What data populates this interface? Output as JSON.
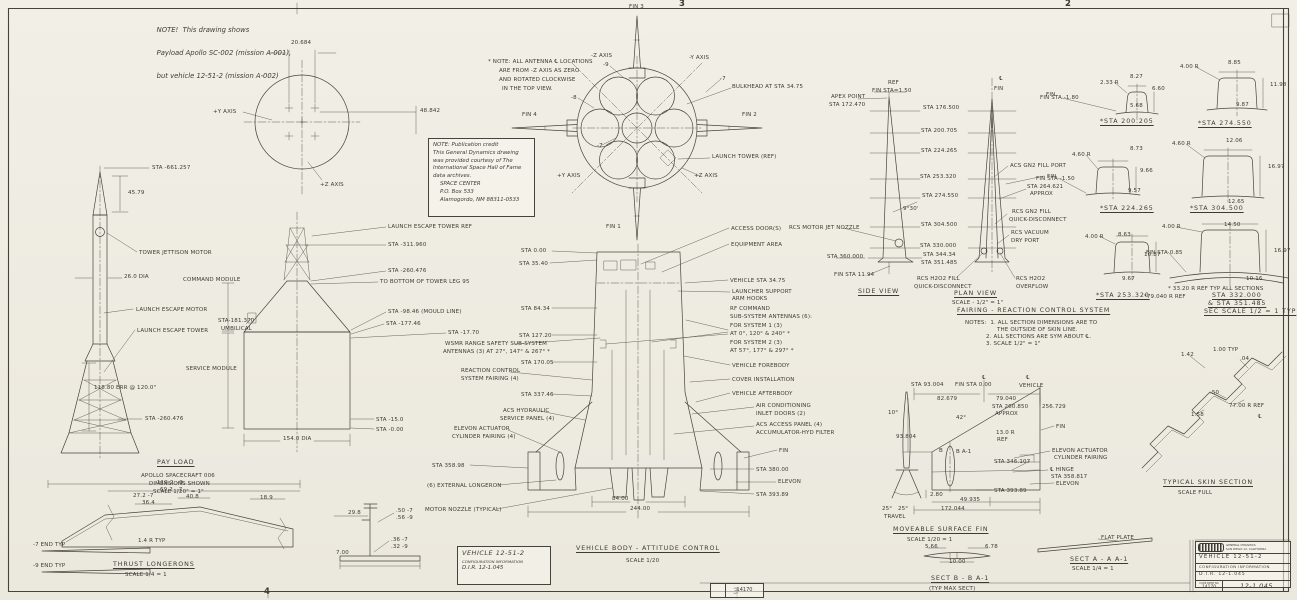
{
  "scope_note": {
    "lines": [
      "NOTE!  This drawing shows",
      "Payload Apollo SC-002 (mission A-001),",
      "but vehicle 12-51-2 (mission A-002)"
    ]
  },
  "credit_note": {
    "lines": [
      "NOTE: Publication credit",
      "This General Dynamics drawing",
      "was provided courtesy of The",
      "International Space Hall of Fame",
      "data archives.",
      "SPACE CENTER",
      "P.O. Box 533",
      "Alamogordo, NM 88311-0533"
    ]
  },
  "info_box": {
    "vehicle": "VEHICLE  12-51-2",
    "config": "CONFIGURATION INFORMATION",
    "dir": "D.I.R.  12-1.045"
  },
  "title_block": {
    "company": "GENERAL DYNAMICS",
    "location": "SAN DIEGO 12, CALIFORNIA",
    "vehicle": "VEHICLE  12-51-2",
    "config": "CONFIGURATION INFORMATION",
    "dir": "D.I.R.  12-1.045",
    "code_label": "CODE IDENT NO",
    "code": "14170",
    "number": "12-1.045"
  },
  "stamp": {
    "number": "14170"
  },
  "labels": [
    {
      "t": "20.684",
      "x": 291,
      "y": 40
    },
    {
      "t": "48.842",
      "x": 420,
      "y": 108
    },
    {
      "t": "+Y AXIS",
      "x": 213,
      "y": 109
    },
    {
      "t": "+Z AXIS",
      "x": 320,
      "y": 182
    },
    {
      "t": "STA -661.257",
      "x": 152,
      "y": 165
    },
    {
      "t": "45.79",
      "x": 128,
      "y": 190
    },
    {
      "t": "TOWER JETTISON MOTOR",
      "x": 139,
      "y": 250
    },
    {
      "t": "26.0 DIA",
      "x": 124,
      "y": 274
    },
    {
      "t": "LAUNCH ESCAPE MOTOR",
      "x": 136,
      "y": 307
    },
    {
      "t": "LAUNCH ESCAPE TOWER",
      "x": 137,
      "y": 328
    },
    {
      "t": "118.80 ERR @ 120.0\"",
      "x": 94,
      "y": 385
    },
    {
      "t": "STA -260.476",
      "x": 145,
      "y": 416
    },
    {
      "t": "PAY LOAD",
      "x": 157,
      "y": 459,
      "c": "t"
    },
    {
      "t": "APOLLO SPACECRAFT 006",
      "x": 141,
      "y": 473
    },
    {
      "t": "DIMENSIONS SHOWN",
      "x": 149,
      "y": 481
    },
    {
      "t": "SCALE 1/20\" = 1\"",
      "x": 153,
      "y": 489
    },
    {
      "t": "COMMAND MODULE",
      "x": 183,
      "y": 277
    },
    {
      "t": "STA-181.370",
      "x": 218,
      "y": 318
    },
    {
      "t": "UMBILICAL",
      "x": 221,
      "y": 326
    },
    {
      "t": "SERVICE MODULE",
      "x": 186,
      "y": 366
    },
    {
      "t": "LAUNCH ESCAPE TOWER REF",
      "x": 388,
      "y": 224
    },
    {
      "t": "STA -311.960",
      "x": 388,
      "y": 242
    },
    {
      "t": "STA -260.476",
      "x": 388,
      "y": 268
    },
    {
      "t": "TO BOTTOM OF TOWER LEG 95",
      "x": 380,
      "y": 279
    },
    {
      "t": "STA -98.46 (MOULD LINE)",
      "x": 388,
      "y": 309
    },
    {
      "t": "STA -177.46",
      "x": 386,
      "y": 321
    },
    {
      "t": "STA -17.70",
      "x": 448,
      "y": 330
    },
    {
      "t": "STA -15.0",
      "x": 376,
      "y": 417
    },
    {
      "t": "STA -0.00",
      "x": 376,
      "y": 427
    },
    {
      "t": "154.0 DIA",
      "x": 283,
      "y": 436
    },
    {
      "t": "FIN 3",
      "x": 629,
      "y": 4
    },
    {
      "t": "-Z AXIS",
      "x": 591,
      "y": 53
    },
    {
      "t": "-Y AXIS",
      "x": 689,
      "y": 55
    },
    {
      "t": "* NOTE: ALL ANTENNA ℄ LOCATIONS",
      "x": 488,
      "y": 59
    },
    {
      "t": "ARE FROM -Z AXIS AS ZERO",
      "x": 499,
      "y": 68
    },
    {
      "t": "AND ROTATED CLOCKWISE",
      "x": 499,
      "y": 77
    },
    {
      "t": "IN THE TOP VIEW.",
      "x": 502,
      "y": 86
    },
    {
      "t": "-9",
      "x": 603,
      "y": 62
    },
    {
      "t": "-7",
      "x": 720,
      "y": 76
    },
    {
      "t": "-8",
      "x": 571,
      "y": 95
    },
    {
      "t": "-7",
      "x": 597,
      "y": 143
    },
    {
      "t": "BULKHEAD AT STA 34.75",
      "x": 732,
      "y": 84
    },
    {
      "t": "FIN 4",
      "x": 522,
      "y": 112
    },
    {
      "t": "FIN 2",
      "x": 742,
      "y": 112
    },
    {
      "t": "LAUNCH TOWER (REF)",
      "x": 712,
      "y": 154
    },
    {
      "t": "+Z AXIS",
      "x": 694,
      "y": 173
    },
    {
      "t": "+Y AXIS",
      "x": 557,
      "y": 173
    },
    {
      "t": "FIN 1",
      "x": 606,
      "y": 224
    },
    {
      "t": "STA 0.00",
      "x": 521,
      "y": 248
    },
    {
      "t": "STA 35.40",
      "x": 519,
      "y": 261
    },
    {
      "t": "STA 84.34",
      "x": 521,
      "y": 306
    },
    {
      "t": "STA 127.20",
      "x": 519,
      "y": 333
    },
    {
      "t": "WSMR RANGE SAFETY SUB-SYSTEM",
      "x": 445,
      "y": 341
    },
    {
      "t": "ANTENNAS (3) AT 27°, 147° & 267° *",
      "x": 443,
      "y": 349
    },
    {
      "t": "STA 170.05",
      "x": 521,
      "y": 360
    },
    {
      "t": "REACTION CONTROL",
      "x": 461,
      "y": 368
    },
    {
      "t": "SYSTEM FAIRING (4)",
      "x": 461,
      "y": 376
    },
    {
      "t": "STA 337.46",
      "x": 521,
      "y": 392
    },
    {
      "t": "ACS HYDRAULIC",
      "x": 503,
      "y": 408
    },
    {
      "t": "SERVICE PANEL (4)",
      "x": 500,
      "y": 416
    },
    {
      "t": "ELEVON ACTUATOR",
      "x": 454,
      "y": 426
    },
    {
      "t": "CYLINDER FAIRING (4)",
      "x": 452,
      "y": 434
    },
    {
      "t": "STA 358.98",
      "x": 432,
      "y": 463
    },
    {
      "t": "(6) EXTERNAL LONGERON",
      "x": 427,
      "y": 483
    },
    {
      "t": "MOTOR NOZZLE (TYPICAL)",
      "x": 425,
      "y": 507
    },
    {
      "t": "ACCESS DOOR(S)",
      "x": 731,
      "y": 226
    },
    {
      "t": "EQUIPMENT AREA",
      "x": 731,
      "y": 242
    },
    {
      "t": "VEHICLE STA 34.75",
      "x": 730,
      "y": 278
    },
    {
      "t": "LAUNCHER SUPPORT",
      "x": 732,
      "y": 289
    },
    {
      "t": "ARM HOOKS",
      "x": 732,
      "y": 296
    },
    {
      "t": "RF COMMAND",
      "x": 730,
      "y": 306
    },
    {
      "t": "SUB-SYSTEM ANTENNAS (6):",
      "x": 730,
      "y": 314
    },
    {
      "t": "FOR SYSTEM 1 (3)",
      "x": 730,
      "y": 323
    },
    {
      "t": "AT 0°, 120° & 240° *",
      "x": 730,
      "y": 331
    },
    {
      "t": "FOR SYSTEM 2 (3)",
      "x": 730,
      "y": 340
    },
    {
      "t": "AT 57°, 177° & 297° *",
      "x": 730,
      "y": 348
    },
    {
      "t": "VEHICLE FOREBODY",
      "x": 732,
      "y": 363
    },
    {
      "t": "COVER INSTALLATION",
      "x": 732,
      "y": 377
    },
    {
      "t": "VEHICLE AFTERBODY",
      "x": 732,
      "y": 391
    },
    {
      "t": "AIR CONDITIONING",
      "x": 756,
      "y": 403
    },
    {
      "t": "INLET DOORS (2)",
      "x": 756,
      "y": 411
    },
    {
      "t": "ACS ACCESS PANEL (4)",
      "x": 756,
      "y": 422
    },
    {
      "t": "ACCUMULATOR-HYD FILTER",
      "x": 756,
      "y": 430
    },
    {
      "t": "FIN",
      "x": 779,
      "y": 448
    },
    {
      "t": "STA 380.00",
      "x": 756,
      "y": 467
    },
    {
      "t": "ELEVON",
      "x": 778,
      "y": 479
    },
    {
      "t": "STA 393.89",
      "x": 756,
      "y": 492
    },
    {
      "t": "84.00",
      "x": 612,
      "y": 496
    },
    {
      "t": "244.00",
      "x": 630,
      "y": 506
    },
    {
      "t": "VEHICLE BODY - ATTITUDE CONTROL",
      "x": 576,
      "y": 545,
      "c": "t"
    },
    {
      "t": "SCALE 1/20",
      "x": 626,
      "y": 558
    },
    {
      "t": "REF",
      "x": 888,
      "y": 80
    },
    {
      "t": "FIN STA=1.50",
      "x": 872,
      "y": 88
    },
    {
      "t": "APEX POINT",
      "x": 831,
      "y": 94
    },
    {
      "t": "STA 172.470",
      "x": 829,
      "y": 102
    },
    {
      "t": "℄",
      "x": 999,
      "y": 76
    },
    {
      "t": "FIN",
      "x": 994,
      "y": 86
    },
    {
      "t": "FIN",
      "x": 1046,
      "y": 92
    },
    {
      "t": "STA 176.500",
      "x": 923,
      "y": 105
    },
    {
      "t": "STA 200.705",
      "x": 921,
      "y": 128
    },
    {
      "t": "STA 224.265",
      "x": 921,
      "y": 148
    },
    {
      "t": "STA 253.320",
      "x": 920,
      "y": 174
    },
    {
      "t": "STA 274.550",
      "x": 922,
      "y": 193
    },
    {
      "t": "9°30'",
      "x": 903,
      "y": 206
    },
    {
      "t": "STA 304.500",
      "x": 921,
      "y": 222
    },
    {
      "t": "RCS MOTOR JET NOZZLE",
      "x": 789,
      "y": 225
    },
    {
      "t": "STA 330.000",
      "x": 920,
      "y": 243
    },
    {
      "t": "STA 344.34",
      "x": 923,
      "y": 252
    },
    {
      "t": "STA 351.485",
      "x": 921,
      "y": 260
    },
    {
      "t": "STA 360.000",
      "x": 827,
      "y": 254
    },
    {
      "t": "FIN STA 11.94",
      "x": 834,
      "y": 272
    },
    {
      "t": "SIDE VIEW",
      "x": 858,
      "y": 288,
      "c": "t"
    },
    {
      "t": "PLAN VIEW",
      "x": 954,
      "y": 290,
      "c": "t"
    },
    {
      "t": "SCALE - 1/2\" = 1\"",
      "x": 952,
      "y": 300
    },
    {
      "t": "ACS GN2 FILL PORT",
      "x": 1010,
      "y": 163
    },
    {
      "t": "FIN",
      "x": 1047,
      "y": 174
    },
    {
      "t": "STA 264.621",
      "x": 1027,
      "y": 184
    },
    {
      "t": "APPROX",
      "x": 1030,
      "y": 191
    },
    {
      "t": "RCS GN2 FILL",
      "x": 1012,
      "y": 209
    },
    {
      "t": "QUICK-DISCONNECT",
      "x": 1009,
      "y": 217
    },
    {
      "t": "RCS VACUUM",
      "x": 1011,
      "y": 230
    },
    {
      "t": "DRY PORT",
      "x": 1011,
      "y": 238
    },
    {
      "t": "RCS H2O2 FILL",
      "x": 917,
      "y": 276
    },
    {
      "t": "QUICK-DISCONNECT",
      "x": 914,
      "y": 284
    },
    {
      "t": "RCS H2O2",
      "x": 1016,
      "y": 276
    },
    {
      "t": "OVERFLOW",
      "x": 1016,
      "y": 284
    },
    {
      "t": "FAIRING - REACTION CONTROL SYSTEM",
      "x": 957,
      "y": 307,
      "c": "t"
    },
    {
      "t": "NOTES:  1. ALL SECTION DIMENSIONS ARE TO",
      "x": 965,
      "y": 320
    },
    {
      "t": "THE OUTSIDE OF SKIN LINE.",
      "x": 997,
      "y": 327
    },
    {
      "t": "2. ALL SECTIONS ARE SYM ABOUT ℄.",
      "x": 986,
      "y": 334
    },
    {
      "t": "3. SCALE 1/2\" = 1\"",
      "x": 986,
      "y": 341
    },
    {
      "t": "FIN STA -1.80",
      "x": 1040,
      "y": 95
    },
    {
      "t": "2.33 R",
      "x": 1100,
      "y": 80
    },
    {
      "t": "8.27",
      "x": 1130,
      "y": 74
    },
    {
      "t": "6.60",
      "x": 1152,
      "y": 86
    },
    {
      "t": "5.68",
      "x": 1130,
      "y": 103
    },
    {
      "t": "*STA 200.205",
      "x": 1100,
      "y": 118,
      "c": "t"
    },
    {
      "t": "4.00 R",
      "x": 1180,
      "y": 64
    },
    {
      "t": "8.85",
      "x": 1228,
      "y": 60
    },
    {
      "t": "11.98",
      "x": 1270,
      "y": 82
    },
    {
      "t": "9.87",
      "x": 1236,
      "y": 102
    },
    {
      "t": "*STA 274.550",
      "x": 1198,
      "y": 120,
      "c": "t"
    },
    {
      "t": "FIN STA -1.50",
      "x": 1036,
      "y": 176
    },
    {
      "t": "4.60 R",
      "x": 1072,
      "y": 152
    },
    {
      "t": "8.73",
      "x": 1130,
      "y": 146
    },
    {
      "t": "9.66",
      "x": 1140,
      "y": 168
    },
    {
      "t": "9.57",
      "x": 1128,
      "y": 188
    },
    {
      "t": "*STA 224.265",
      "x": 1100,
      "y": 205,
      "c": "t"
    },
    {
      "t": "4.60 R",
      "x": 1172,
      "y": 141
    },
    {
      "t": "12.06",
      "x": 1226,
      "y": 138
    },
    {
      "t": "16.97",
      "x": 1268,
      "y": 164
    },
    {
      "t": "12.65",
      "x": 1228,
      "y": 199
    },
    {
      "t": "*STA 304.500",
      "x": 1190,
      "y": 205,
      "c": "t"
    },
    {
      "t": "4.00 R",
      "x": 1085,
      "y": 234
    },
    {
      "t": "8.63",
      "x": 1118,
      "y": 232
    },
    {
      "t": "10.87",
      "x": 1144,
      "y": 252
    },
    {
      "t": "9.67",
      "x": 1122,
      "y": 276
    },
    {
      "t": "*STA 253.320",
      "x": 1096,
      "y": 292,
      "c": "t"
    },
    {
      "t": "4.00 R",
      "x": 1162,
      "y": 224
    },
    {
      "t": "14.50",
      "x": 1224,
      "y": 222
    },
    {
      "t": "16.97",
      "x": 1274,
      "y": 248
    },
    {
      "t": "FIN STA 0.85",
      "x": 1146,
      "y": 250
    },
    {
      "t": "10.16",
      "x": 1246,
      "y": 276
    },
    {
      "t": "* 33.20 R REF TYP ALL SECTIONS",
      "x": 1168,
      "y": 286
    },
    {
      "t": "*79.040 R REF",
      "x": 1144,
      "y": 294
    },
    {
      "t": "STA 332.000",
      "x": 1212,
      "y": 292,
      "c": "t"
    },
    {
      "t": "& STA 351.485",
      "x": 1208,
      "y": 300,
      "c": "t"
    },
    {
      "t": "SEC SCALE 1/2 = 1 TYP",
      "x": 1204,
      "y": 308,
      "c": "t"
    },
    {
      "t": "1.42",
      "x": 1181,
      "y": 352
    },
    {
      "t": "1.00 TYP",
      "x": 1213,
      "y": 347
    },
    {
      "t": ".04",
      "x": 1240,
      "y": 356
    },
    {
      "t": ".50",
      "x": 1210,
      "y": 390
    },
    {
      "t": "77.00 R REF",
      "x": 1229,
      "y": 403
    },
    {
      "t": "1.58",
      "x": 1191,
      "y": 412
    },
    {
      "t": "℄",
      "x": 1258,
      "y": 414
    },
    {
      "t": "TYPICAL SKIN SECTION",
      "x": 1163,
      "y": 479,
      "c": "t"
    },
    {
      "t": "SCALE FULL",
      "x": 1178,
      "y": 490
    },
    {
      "t": "STA 93.004",
      "x": 911,
      "y": 382
    },
    {
      "t": "FIN STA 0.00",
      "x": 955,
      "y": 382
    },
    {
      "t": "℄",
      "x": 982,
      "y": 375
    },
    {
      "t": "℄",
      "x": 1026,
      "y": 375
    },
    {
      "t": "VEHICLE",
      "x": 1019,
      "y": 383
    },
    {
      "t": "82.679",
      "x": 937,
      "y": 396
    },
    {
      "t": "79.040",
      "x": 996,
      "y": 396
    },
    {
      "t": "STA 260.850",
      "x": 992,
      "y": 404
    },
    {
      "t": "APPROX",
      "x": 995,
      "y": 411
    },
    {
      "t": "256.729",
      "x": 1042,
      "y": 404
    },
    {
      "t": "10°",
      "x": 888,
      "y": 410
    },
    {
      "t": "42°",
      "x": 956,
      "y": 415
    },
    {
      "t": "93.804",
      "x": 896,
      "y": 434
    },
    {
      "t": "FIN",
      "x": 1056,
      "y": 424
    },
    {
      "t": "13.0 R",
      "x": 996,
      "y": 430
    },
    {
      "t": "REF",
      "x": 997,
      "y": 437
    },
    {
      "t": "B",
      "x": 939,
      "y": 448
    },
    {
      "t": "B A-1",
      "x": 956,
      "y": 449
    },
    {
      "t": "ELEVON ACTUATOR",
      "x": 1052,
      "y": 448
    },
    {
      "t": "CYLINDER FAIRING",
      "x": 1054,
      "y": 455
    },
    {
      "t": "STA 346.107",
      "x": 994,
      "y": 459
    },
    {
      "t": "℄ HINGE",
      "x": 1050,
      "y": 467
    },
    {
      "t": "STA 358.817",
      "x": 1051,
      "y": 474
    },
    {
      "t": "ELEVON",
      "x": 1056,
      "y": 481
    },
    {
      "t": "STA 393.89",
      "x": 994,
      "y": 488
    },
    {
      "t": "2.80",
      "x": 930,
      "y": 492
    },
    {
      "t": "49.935",
      "x": 960,
      "y": 497
    },
    {
      "t": "172.044",
      "x": 941,
      "y": 506
    },
    {
      "t": "25°",
      "x": 882,
      "y": 506
    },
    {
      "t": "25°",
      "x": 898,
      "y": 506
    },
    {
      "t": "TRAVEL",
      "x": 884,
      "y": 514
    },
    {
      "t": "MOVEABLE SURFACE FIN",
      "x": 893,
      "y": 526,
      "c": "t"
    },
    {
      "t": "SCALE 1/20 = 1",
      "x": 907,
      "y": 537
    },
    {
      "t": "5.66",
      "x": 925,
      "y": 544
    },
    {
      "t": "6.78",
      "x": 985,
      "y": 544
    },
    {
      "t": "10.00",
      "x": 949,
      "y": 559
    },
    {
      "t": "SECT B - B A-1",
      "x": 931,
      "y": 575,
      "c": "t"
    },
    {
      "t": "(TYP MAX SECT)",
      "x": 929,
      "y": 586
    },
    {
      "t": "FLAT PLATE",
      "x": 1101,
      "y": 535
    },
    {
      "t": "SECT A - A A-1",
      "x": 1070,
      "y": 556,
      "c": "t"
    },
    {
      "t": "SCALE 1/4 = 1",
      "x": 1072,
      "y": 566
    },
    {
      "t": "119.2  -9",
      "x": 157,
      "y": 480
    },
    {
      "t": "69.2  -7",
      "x": 160,
      "y": 487
    },
    {
      "t": "27.2 -7",
      "x": 133,
      "y": 493
    },
    {
      "t": "36.4",
      "x": 142,
      "y": 500
    },
    {
      "t": "40.8",
      "x": 186,
      "y": 494
    },
    {
      "t": "18.9",
      "x": 260,
      "y": 495
    },
    {
      "t": "1.4 R TYP",
      "x": 138,
      "y": 538
    },
    {
      "t": "-7 END TYP",
      "x": 33,
      "y": 542
    },
    {
      "t": "-9 END TYP",
      "x": 33,
      "y": 563
    },
    {
      "t": "THRUST LONGERONS",
      "x": 113,
      "y": 561,
      "c": "t"
    },
    {
      "t": "SCALE 1/4 = 1",
      "x": 125,
      "y": 572
    },
    {
      "t": "29.8",
      "x": 348,
      "y": 510
    },
    {
      "t": ".50 -7",
      "x": 396,
      "y": 508
    },
    {
      "t": ".56 -9",
      "x": 396,
      "y": 515
    },
    {
      "t": ".36 -7",
      "x": 391,
      "y": 537
    },
    {
      "t": ".32 -9",
      "x": 391,
      "y": 544
    },
    {
      "t": "7.00",
      "x": 336,
      "y": 550
    },
    {
      "t": "3",
      "x": 679,
      "y": 0,
      "c": "z"
    },
    {
      "t": "2",
      "x": 1065,
      "y": 0,
      "c": "z"
    },
    {
      "t": "4",
      "x": 264,
      "y": 588,
      "c": "z"
    },
    {
      "t": "3",
      "x": 733,
      "y": 588,
      "c": "z"
    }
  ]
}
